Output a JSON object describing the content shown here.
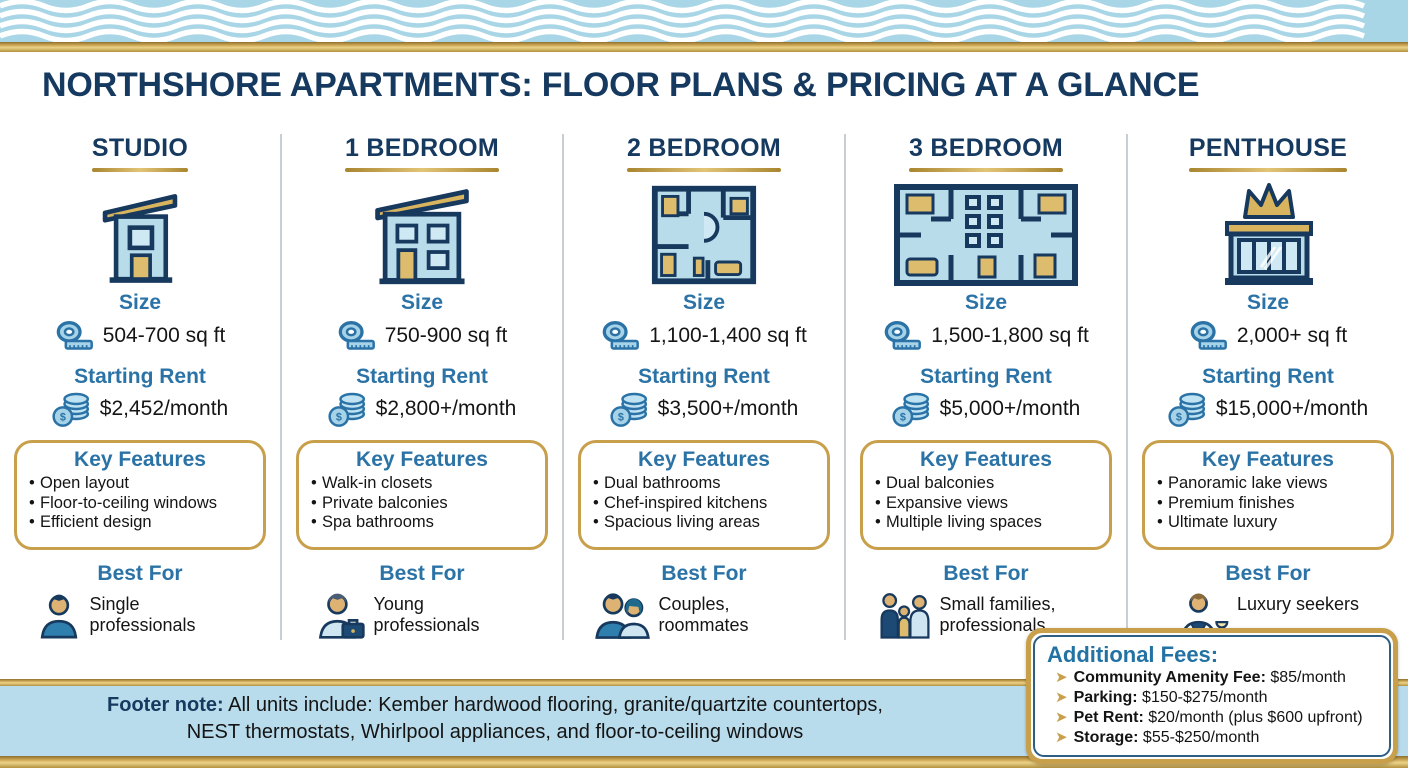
{
  "title": "NORTHSHORE APARTMENTS: FLOOR PLANS & PRICING AT A GLANCE",
  "labels": {
    "size": "Size",
    "rent": "Starting Rent",
    "features": "Key Features",
    "best_for": "Best For"
  },
  "columns": [
    {
      "name": "STUDIO",
      "size": "504-700 sq ft",
      "rent": "$2,452/month",
      "features": [
        "Open layout",
        "Floor-to-ceiling windows",
        "Efficient design"
      ],
      "best_for": "Single professionals"
    },
    {
      "name": "1 BEDROOM",
      "size": "750-900 sq ft",
      "rent": "$2,800+/month",
      "features": [
        "Walk-in closets",
        "Private balconies",
        "Spa bathrooms"
      ],
      "best_for": "Young professionals"
    },
    {
      "name": "2 BEDROOM",
      "size": "1,100-1,400 sq ft",
      "rent": "$3,500+/month",
      "features": [
        "Dual bathrooms",
        "Chef-inspired kitchens",
        "Spacious living areas"
      ],
      "best_for": "Couples, roommates"
    },
    {
      "name": "3 BEDROOM",
      "size": "1,500-1,800 sq ft",
      "rent": "$5,000+/month",
      "features": [
        "Dual balconies",
        "Expansive views",
        "Multiple living spaces"
      ],
      "best_for": "Small families, professionals"
    },
    {
      "name": "PENTHOUSE",
      "size": "2,000+ sq ft",
      "rent": "$15,000+/month",
      "features": [
        "Panoramic lake views",
        "Premium finishes",
        "Ultimate luxury"
      ],
      "best_for": "Luxury seekers"
    }
  ],
  "footer": {
    "label": "Footer note:",
    "line1": "All units include: Kember hardwood flooring, granite/quartzite countertops,",
    "line2": "NEST thermostats, Whirlpool appliances, and floor-to-ceiling windows"
  },
  "additional_fees": {
    "title": "Additional Fees:",
    "items": [
      {
        "label": "Community Amenity Fee: ",
        "value": "$85/month"
      },
      {
        "label": "Parking: ",
        "value": "$150-$275/month"
      },
      {
        "label": "Pet Rent: ",
        "value": "$20/month (plus $600 upfront)"
      },
      {
        "label": "Storage: ",
        "value": "$55-$250/month"
      }
    ]
  },
  "icons": {
    "dollar_glyph": "$",
    "size": "tape-measure-icon",
    "rent": "coin-stack-icon",
    "fees_bullet": "arrow-bullet-icon",
    "columns": [
      "studio-building-icon",
      "one-bedroom-building-icon",
      "two-bedroom-floorplan-icon",
      "three-bedroom-floorplan-icon",
      "penthouse-crown-icon"
    ],
    "best_for": [
      "single-person-icon",
      "briefcase-person-icon",
      "couple-icon",
      "family-icon",
      "luxury-person-icon"
    ]
  },
  "colors": {
    "navy": "#16395f",
    "header_blue": "#2b73a6",
    "gold": "#c8a04b",
    "icon_light_blue": "#b8dcea",
    "footer_band_blue": "#b9dcec",
    "text": "#141414"
  }
}
